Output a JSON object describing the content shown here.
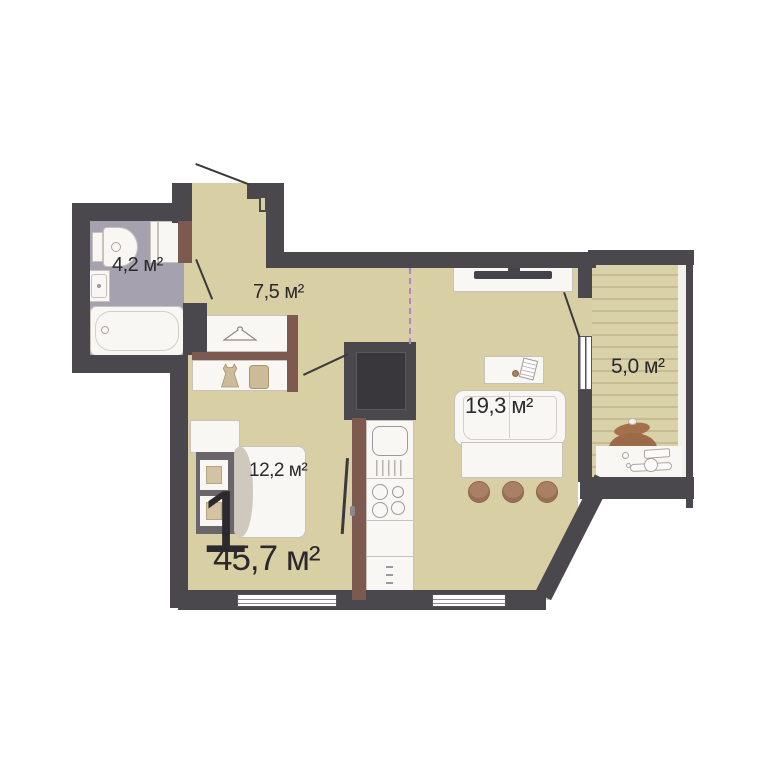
{
  "plan": {
    "apartment_rooms_count": "1",
    "total_area_label": "45,7 м²",
    "rooms": [
      {
        "name": "bathroom",
        "area_label": "4,2 м²"
      },
      {
        "name": "hallway",
        "area_label": "7,5 м²"
      },
      {
        "name": "bedroom-zone",
        "area_label": "12,2 м²"
      },
      {
        "name": "living-kitchen",
        "area_label": "19,3 м²"
      },
      {
        "name": "balcony",
        "area_label": "5,0 м²"
      }
    ],
    "palette": {
      "exterior_wall": "#4b484d",
      "partition_wall": "#7c5a50",
      "floor": "#d8d0a4",
      "bathroom_floor": "#a6a1af",
      "balcony_floor": "#d9d1a8",
      "furniture": "#f8f7f4",
      "wood_accent": "#aa8065",
      "zone_boundary_line": "#b583c8",
      "text": "#2b292d"
    }
  }
}
